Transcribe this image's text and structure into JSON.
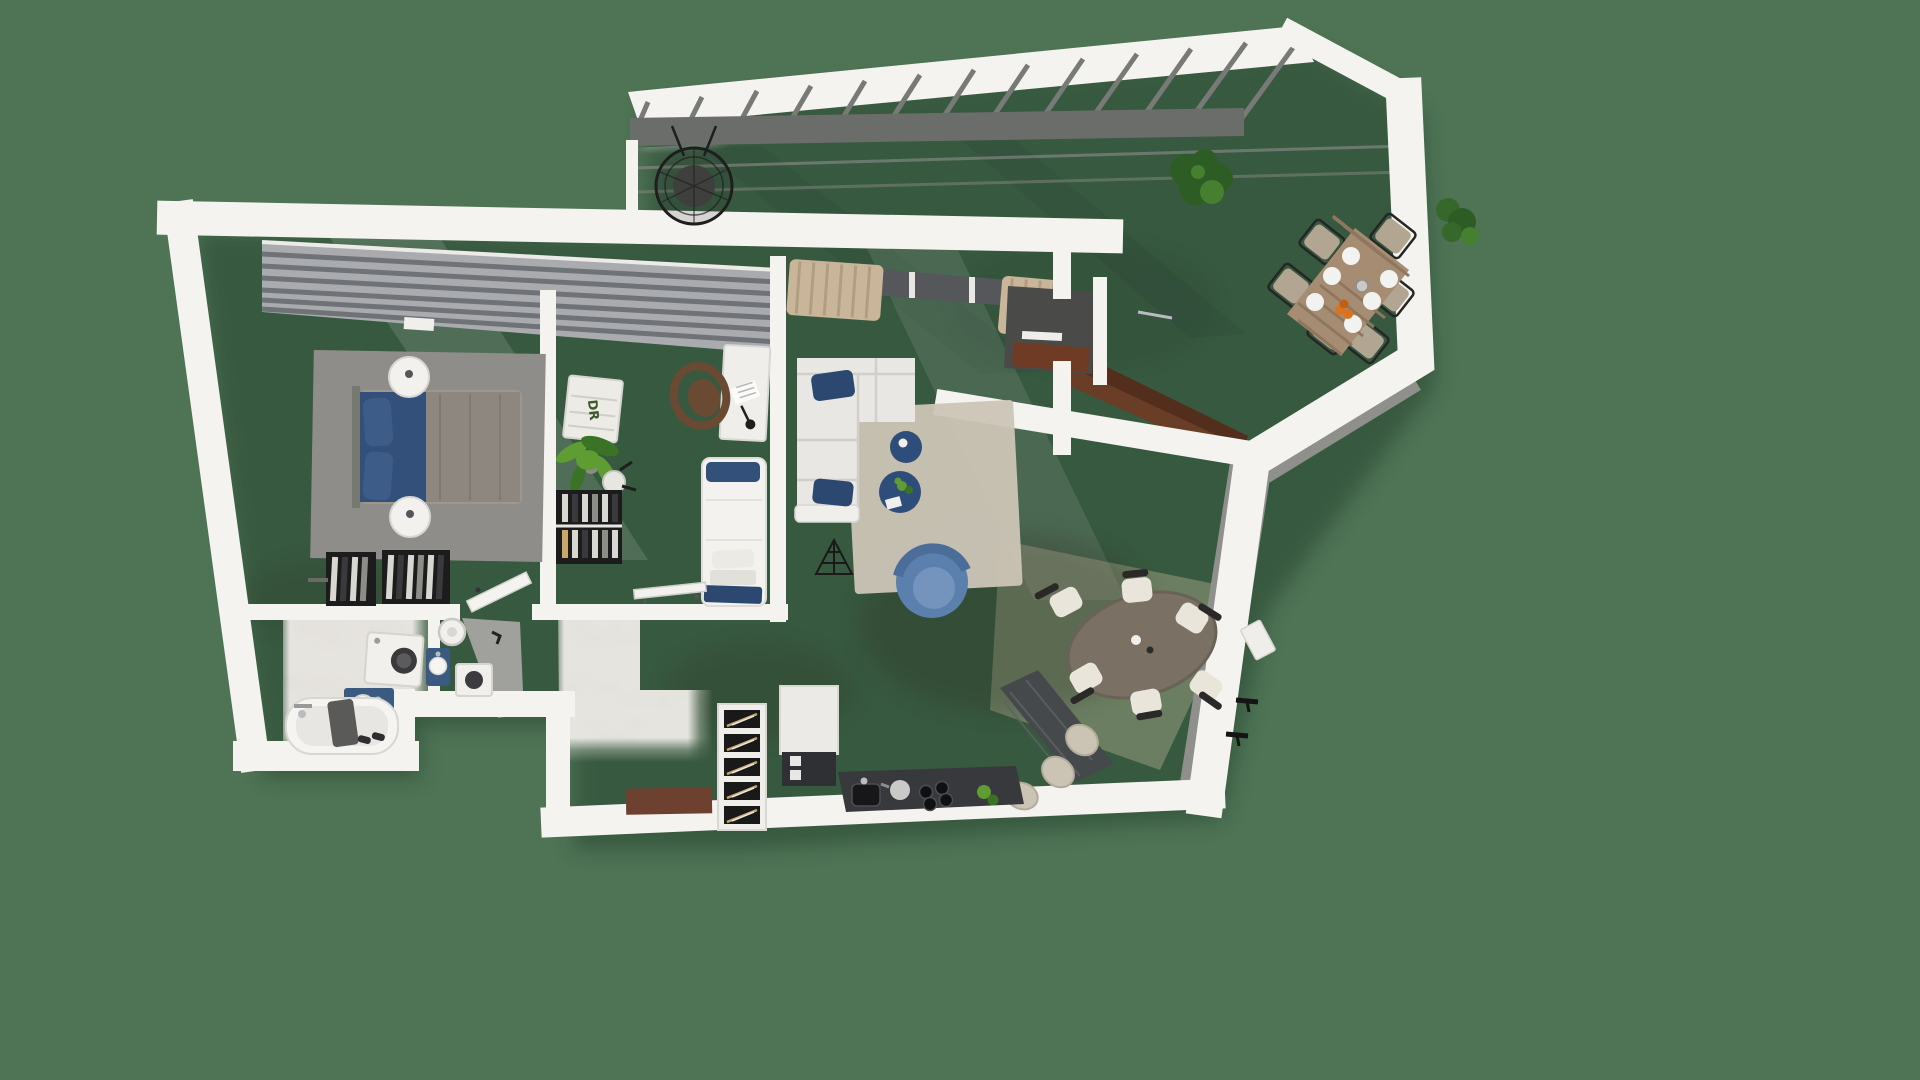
{
  "scene": {
    "type": "3d-floor-plan-render",
    "view": "top-down axonometric",
    "description": "Two-bedroom apartment with open living-dining-kitchen space, bathroom block and large wrap-around terrace with pergola"
  },
  "labels": {
    "dresser_monogram": "DR"
  },
  "palette": {
    "bg": "#4e7355",
    "silhouetteShadow": "#24402c",
    "wall": "#f4f3ef",
    "wallShade": "#dcdbd5",
    "wallFace": "#8f8f8b",
    "wallFaceDark": "#7d7d79",
    "wood": "#b89e85",
    "woodLight": "#dcc5a9",
    "tile": "#cdcdcb",
    "tileLine": "#9c9c9a",
    "marble": "#e6e4df",
    "blinds": "#a9abaf",
    "blindSlat": "#6f7277",
    "frameDark": "#55575b",
    "curtain": "#c9b69a",
    "rugBedroom": "#8f8d89",
    "rugLiving": "#ccc5b6",
    "navy": "#33507b",
    "navyDark": "#2c4870",
    "navyLight": "#3d5c88",
    "sofa": "#e8e7e3",
    "armchairBlue": "#5c80ae",
    "armchairSeat": "#7494bd",
    "poufNavy": "#2f4d7a",
    "furnitureWhite": "#f2f1ed",
    "deskChairWood": "#6b4a33",
    "wardrobeDark": "#1c1c1c",
    "clothesLight": "#d9d7d2",
    "plantGreen": "#5f9c31",
    "plantDark": "#3a7226",
    "plantTerrace": "#2e5c25",
    "diningTable": "#7a7164",
    "chairCream": "#e9e5da",
    "chairRail": "#2b2927",
    "islandDark": "#45494c",
    "counterDark": "#37393c",
    "appliance": "#17171a",
    "steel": "#b9bcc0",
    "stoolBeige": "#cbc3b4",
    "terraceTableWood": "#a68c72",
    "terraceChairCushion": "#b2a692",
    "terraceChairFrame": "#262626",
    "plate": "#f2f2f0",
    "fruitOrange": "#d9731f",
    "pergolaRail": "#6b6d6a",
    "rafter": "#787a77",
    "alcoveDark": "#4a4a48",
    "alcoveBrown": "#6f3b24",
    "entryMat": "#6e4030",
    "tubWhite": "#f5f4f1",
    "tubInner": "#e7e6e2",
    "towelGrey": "#5a5a58",
    "vanityNavy": "#3a5a80",
    "washerWhite": "#f1f0ec",
    "washerDoor": "#3a3a3c",
    "greyWedge": "#a0a09c"
  },
  "rooms": [
    {
      "name": "master-bedroom",
      "furniture": [
        "double bed with blue bedding",
        "two round nightstands",
        "grey area rug",
        "built-in wardrobe with hanging clothes",
        "window blinds",
        "wall shelf"
      ]
    },
    {
      "name": "second-bedroom",
      "furniture": [
        "single bed with navy pillows",
        "white desk",
        "wooden desk chair",
        "desk lamp",
        "white dresser",
        "potted palm",
        "small stool",
        "open wardrobe with clothes",
        "radiator",
        "window blinds"
      ]
    },
    {
      "name": "living-room",
      "furniture": [
        "L-shaped corner sofa",
        "navy cushions",
        "two round navy coffee tables",
        "blue swivel armchair",
        "beige area rug",
        "black wire decor",
        "curtains",
        "tv alcove with wood sideboard"
      ]
    },
    {
      "name": "dining-area",
      "furniture": [
        "oval dining table",
        "six cream chairs with dark rails",
        "wall lamps",
        "wall console"
      ]
    },
    {
      "name": "kitchen",
      "furniture": [
        "dark stone island",
        "bar stools",
        "dark counter with sink",
        "hob with pots",
        "oven column",
        "tall cabinet",
        "herb plant"
      ]
    },
    {
      "name": "hallway",
      "furniture": [
        "tall storage rack with bottles",
        "entry mat",
        "interior door"
      ]
    },
    {
      "name": "bathroom",
      "furniture": [
        "bathtub",
        "washing machine",
        "navy vanity with oval sink",
        "towel"
      ]
    },
    {
      "name": "wc-laundry",
      "furniture": [
        "water heater",
        "compact navy vanity",
        "compact laundry machine"
      ]
    },
    {
      "name": "terrace",
      "furniture": [
        "pergola with rafters",
        "hanging egg chair",
        "slatted outdoor dining table",
        "six outdoor chairs",
        "plates and fruit bowl",
        "potted plants",
        "concrete floor tiles"
      ]
    }
  ]
}
